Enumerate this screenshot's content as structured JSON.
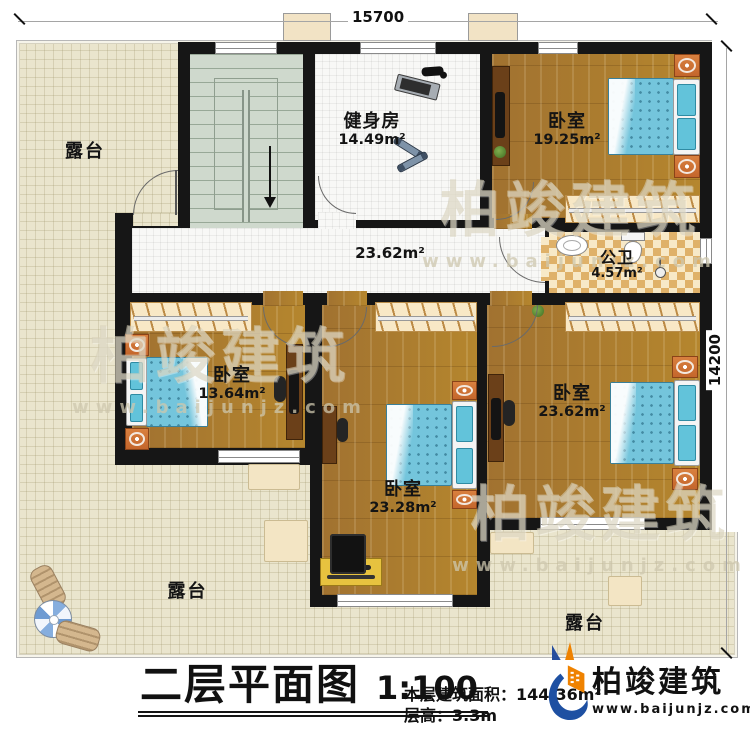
{
  "plan": {
    "dim_top": "15700",
    "dim_right": "14200",
    "rooms": {
      "terrace_tl": "露台",
      "terrace_bl": "露台",
      "terrace_br": "露台",
      "gym_name": "健身房",
      "gym_area": "14.49m²",
      "bed_tr_name": "卧室",
      "bed_tr_area": "19.25m²",
      "bath_name": "公卫",
      "bath_area": "4.57m²",
      "hall_area": "23.62m²",
      "bed_l_name": "卧室",
      "bed_l_area": "13.64m²",
      "bed_c_name": "卧室",
      "bed_c_area": "23.28m²",
      "bed_r_name": "卧室",
      "bed_r_area": "23.62m²"
    }
  },
  "watermark": {
    "name": "柏竣建筑",
    "url": "www.baijunjz.com"
  },
  "caption": {
    "title": "二层平面图",
    "scale": "1:100",
    "area_line": "本层建筑面积：144.36m²",
    "height_line": "层高：3.3m"
  },
  "brand": {
    "name": "柏竣建筑",
    "url": "www.baijunjz.com"
  },
  "colors": {
    "wall": "#161616",
    "wood": "#a87a35",
    "terrace": "#eae5cd",
    "bed_blue": "#74c5dc",
    "brand_blue": "#1e50a2",
    "brand_orange": "#ef8200"
  }
}
